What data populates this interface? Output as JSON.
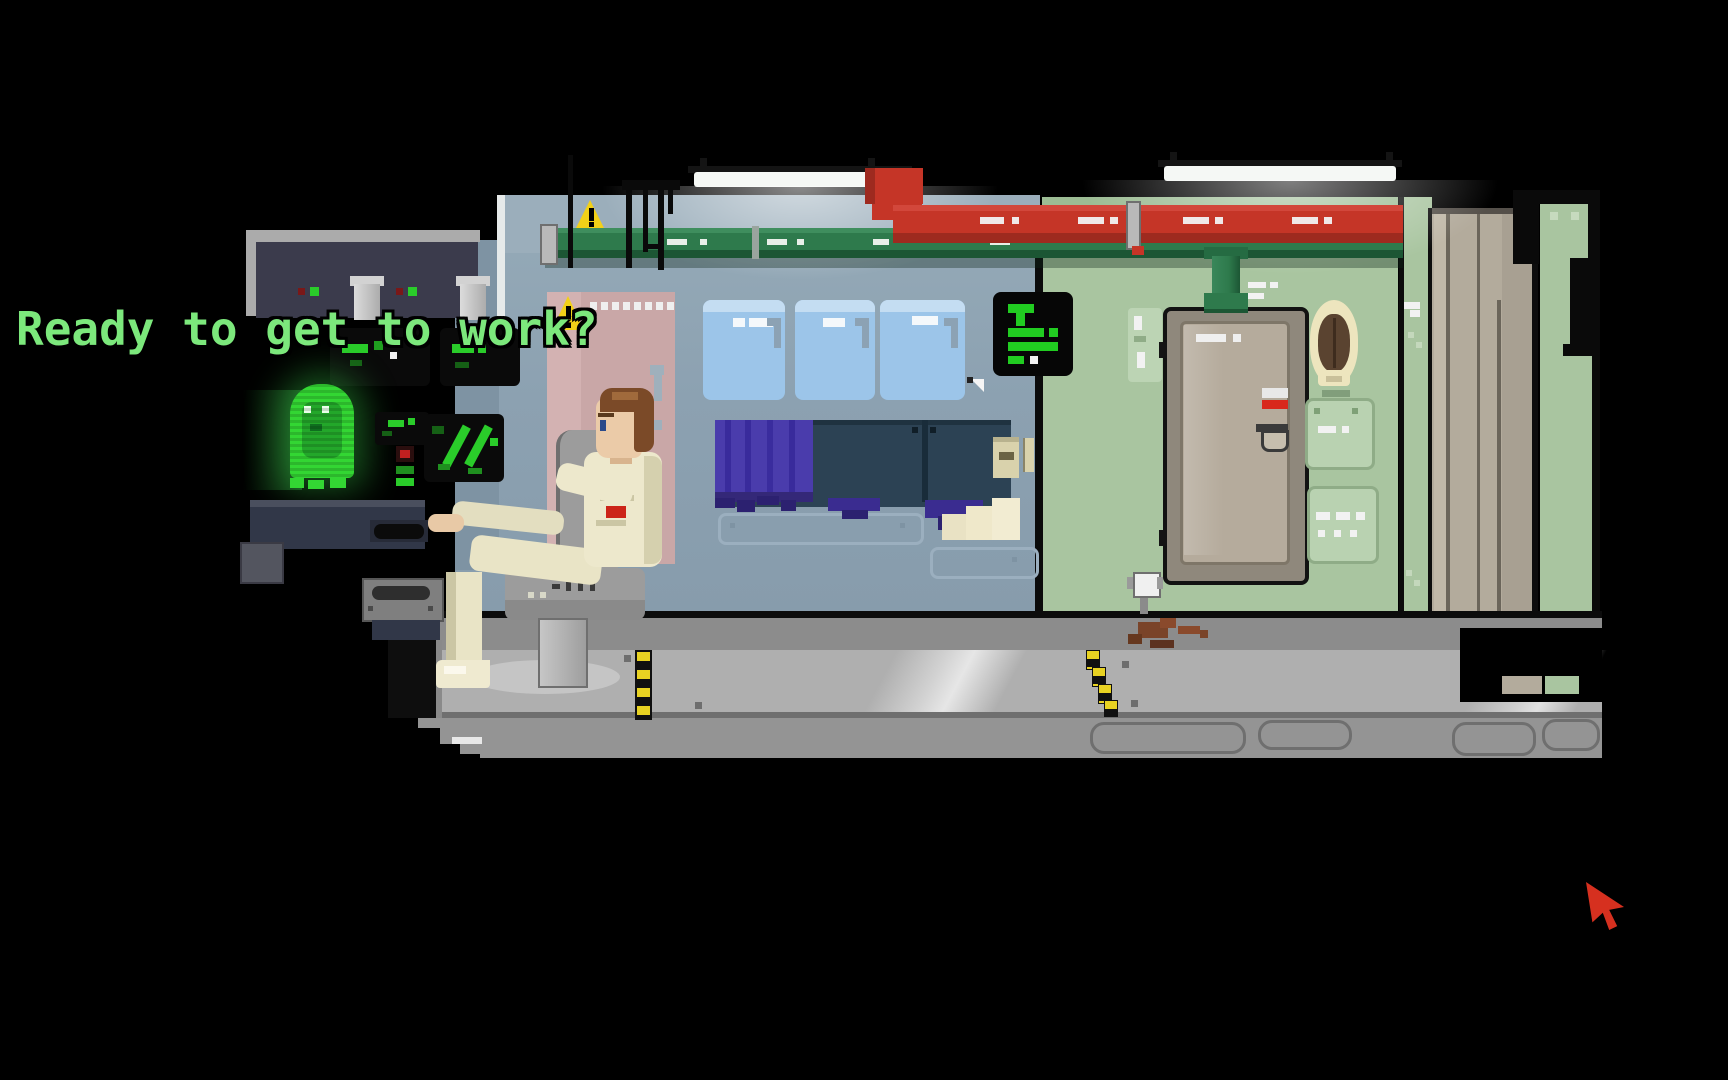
{
  "dialogue": {
    "line": "Ready to get to work?",
    "color": "#7CE87C"
  },
  "cursor": {
    "icon": "red-arrow-cursor",
    "color": "#D6301F"
  },
  "scene": {
    "style": "pixel-art adventure game spaceship cabin",
    "objects": [
      "ceiling-light",
      "green-pipe",
      "red-pipe",
      "warning-sign",
      "control-console",
      "console-screen",
      "hologram-ghost",
      "operator-character",
      "office-chair",
      "pink-locker",
      "porthole-window",
      "bunk-curtain",
      "bunk-bed",
      "pinned-note",
      "terminal-screen",
      "cabin-door",
      "mirror",
      "wall-vent",
      "locker-door",
      "hazard-strip",
      "floor-stain",
      "wall-knob"
    ]
  },
  "palette": {
    "background": "#000000",
    "dialogue_green": "#7CE87C",
    "wall_blue": "#8CA1B1",
    "wall_green": "#A9C5A0",
    "pipe_green": "#2E7A4C",
    "pipe_red": "#C53527",
    "window_blue": "#9CC5E9",
    "curtain_purple": "#4A3CAC",
    "bunk_teal": "#2C4254",
    "door_tan": "#B5AB9C",
    "pink_panel": "#C9A7A7",
    "floor_gray": "#AFAFAF",
    "hazard_yellow": "#E8D222",
    "hologram_green": "#33D633",
    "cursor_red": "#D6301F"
  }
}
